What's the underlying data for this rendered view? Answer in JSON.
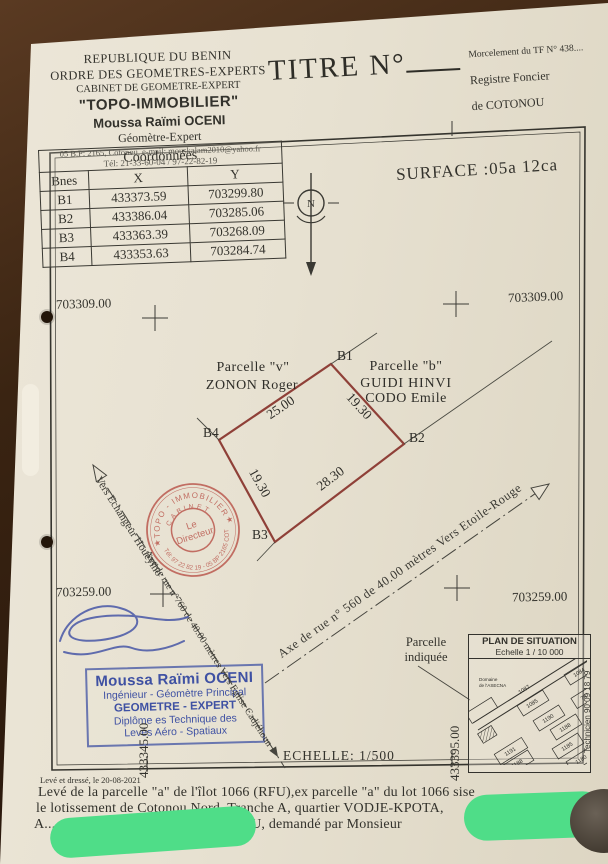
{
  "header": {
    "org_lines": [
      "REPUBLIQUE DU BENIN",
      "ORDRE DES GEOMETRES-EXPERTS",
      "CABINET DE GEOMETRE-EXPERT"
    ],
    "cabinet_name": "\"TOPO-IMMOBILIER\"",
    "surveyor": "Moussa Raïmi OCENI",
    "surveyor_title": "Géomètre-Expert",
    "address": "05 B.P: 2165, Cotonou, e-mail: mouskalam2010@yahoo.fr",
    "phone": "Tél: 21-33-60-04 / 97-22-82-19",
    "title": "TITRE N°",
    "right_lines": [
      "Morcelement du TF N° 438....",
      "Registre Foncier",
      "de COTONOU"
    ]
  },
  "coords": {
    "title": "Coordonnées",
    "columns": [
      "Bnes",
      "X",
      "Y"
    ],
    "rows": [
      [
        "B1",
        "433373.59",
        "703299.80"
      ],
      [
        "B2",
        "433386.04",
        "703285.06"
      ],
      [
        "B3",
        "433363.39",
        "703268.09"
      ],
      [
        "B4",
        "433353.63",
        "703284.74"
      ]
    ]
  },
  "surface_label": "SURFACE :05a 12ca",
  "north_letter": "N",
  "grid": {
    "top_left": "703309.00",
    "top_right": "703309.00",
    "bottom_left": "703259.00",
    "bottom_right": "703259.00",
    "left_vertical": "433345.00",
    "right_vertical": "433395.00"
  },
  "parcel": {
    "corner_labels": [
      "B1",
      "B2",
      "B3",
      "B4"
    ],
    "side_labels": [
      "25.00",
      "19.30",
      "28.30",
      "19.30"
    ],
    "neighbor_left": [
      "Parcelle \"v\"",
      "ZONON Roger"
    ],
    "neighbor_right": [
      "Parcelle \"b\"",
      "GUIDI HINVI",
      "CODO Emile"
    ],
    "line_color": "#8f4038"
  },
  "streets": {
    "left_upper": "Vers Echangeur Houéyiho",
    "left_lower": "Axe de rue n°760 de 40.00 mètres Vers Eglise Cadjéhoun",
    "right": "Axe de rue n° 560 de 40.00 mètres Vers Etoile-Rouge"
  },
  "red_stamp": {
    "arc_top": "TOPO - IMMOBILIER",
    "arc_inner": "CABINET",
    "center_line1": "Le",
    "center_line2": "Directeur",
    "arc_bottom": "Tél: 97 22 82 19 - 05 BP 2165 COT",
    "star_left": "★",
    "star_right": "★",
    "color": "#b9544a"
  },
  "blue_stamp": {
    "lines": [
      "Moussa Raïmi OCENI",
      "Ingénieur - Géomètre Principal",
      "GEOMETRE - EXPERT",
      "Diplôme es Technique des",
      "Levés  Aéro - Spatiaux"
    ]
  },
  "pointer": {
    "line1": "Parcelle",
    "line2": "indiquée"
  },
  "situation_plan": {
    "title": "PLAN DE SITUATION",
    "scale": "Echelle 1 / 10 000",
    "domain_line1": "Domaine",
    "domain_line2": "de l'ASECNA",
    "blocks": [
      "1084",
      "1087",
      "1085",
      "783",
      "1190",
      "1188",
      "1191",
      "1185",
      "1188",
      "1180"
    ]
  },
  "technician_note": "Technicien 90 09 18 79",
  "scale_label": "ECHELLE: 1/500",
  "footer": {
    "date_line": "Levé et dressé, le 20-08-2021",
    "line1": "Levé de la  parcelle \"a\" de l'îlot 1066 (RFU),ex parcelle \"a\" du lot 1066 sise",
    "line2": "le lotissement de Cotonou Nord, Tranche A, quartier VODJE-KPOTA,",
    "line3": "A.............nt, Commune de COTONOU, demandé par Monsieur"
  }
}
